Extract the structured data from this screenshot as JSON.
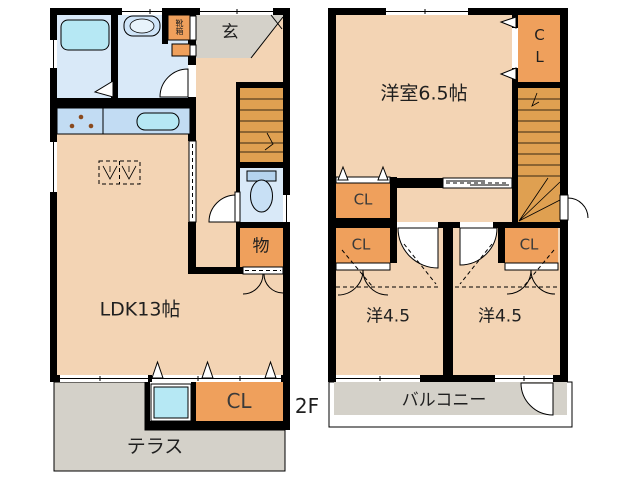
{
  "palette": {
    "wall": "#000000",
    "room": "#f3d4b4",
    "closet": "#efa05c",
    "stairs": "#dfa051",
    "wet": "#d9e9f8",
    "fixture": "#b6e8f4",
    "counter": "#c2dcf3",
    "gray": "#d4d1c9",
    "label": "#1f1f1f"
  },
  "floor1": {
    "rooms": {
      "ldk": "LDK13帖",
      "entrance": "玄",
      "shoe_box": "靴箱",
      "storage": "物",
      "closet": "CL",
      "terrace": "テラス"
    }
  },
  "floor2": {
    "label": "2F",
    "rooms": {
      "main": "洋室6.5帖",
      "closet_top": "CL",
      "closet_left_upper": "CL",
      "closet_left_lower": "CL",
      "closet_right": "CL",
      "room_left": "洋4.5",
      "room_right": "洋4.5",
      "balcony": "バルコニー"
    }
  }
}
